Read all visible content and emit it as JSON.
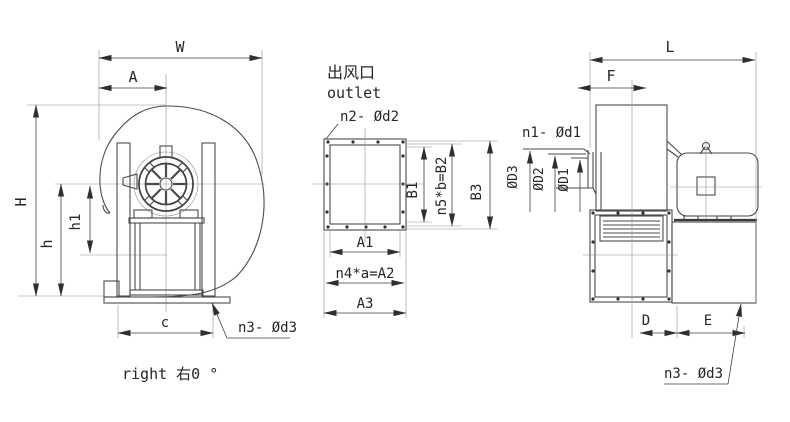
{
  "title": "Centrifugal fan outline dimension drawing",
  "colors": {
    "line": "#4a4a4a",
    "text": "#262626",
    "background": "#ffffff"
  },
  "left_view": {
    "dim_w": "W",
    "dim_a": "A",
    "dim_h_total": "H",
    "dim_h": "h",
    "dim_h1": "h1",
    "dim_c": "c",
    "bolt_note": "n3- Ød3",
    "caption": "right 右0 °"
  },
  "outlet_view": {
    "title_cn": "出风口",
    "title_en": "outlet",
    "bolt_note": "n2- Ød2",
    "dim_b1": "B1",
    "dim_b2": "n5*b=B2",
    "dim_b3": "B3",
    "dim_a1": "A1",
    "dim_a2": "n4*a=A2",
    "dim_a3": "A3"
  },
  "side_view": {
    "dim_l": "L",
    "dim_f": "F",
    "inlet_bolt_note": "n1- Ød1",
    "dim_d3": "ØD3",
    "dim_d2": "ØD2",
    "dim_d1": "ØD1",
    "dim_d": "D",
    "dim_e": "E",
    "base_bolt_note": "n3- Ød3"
  }
}
